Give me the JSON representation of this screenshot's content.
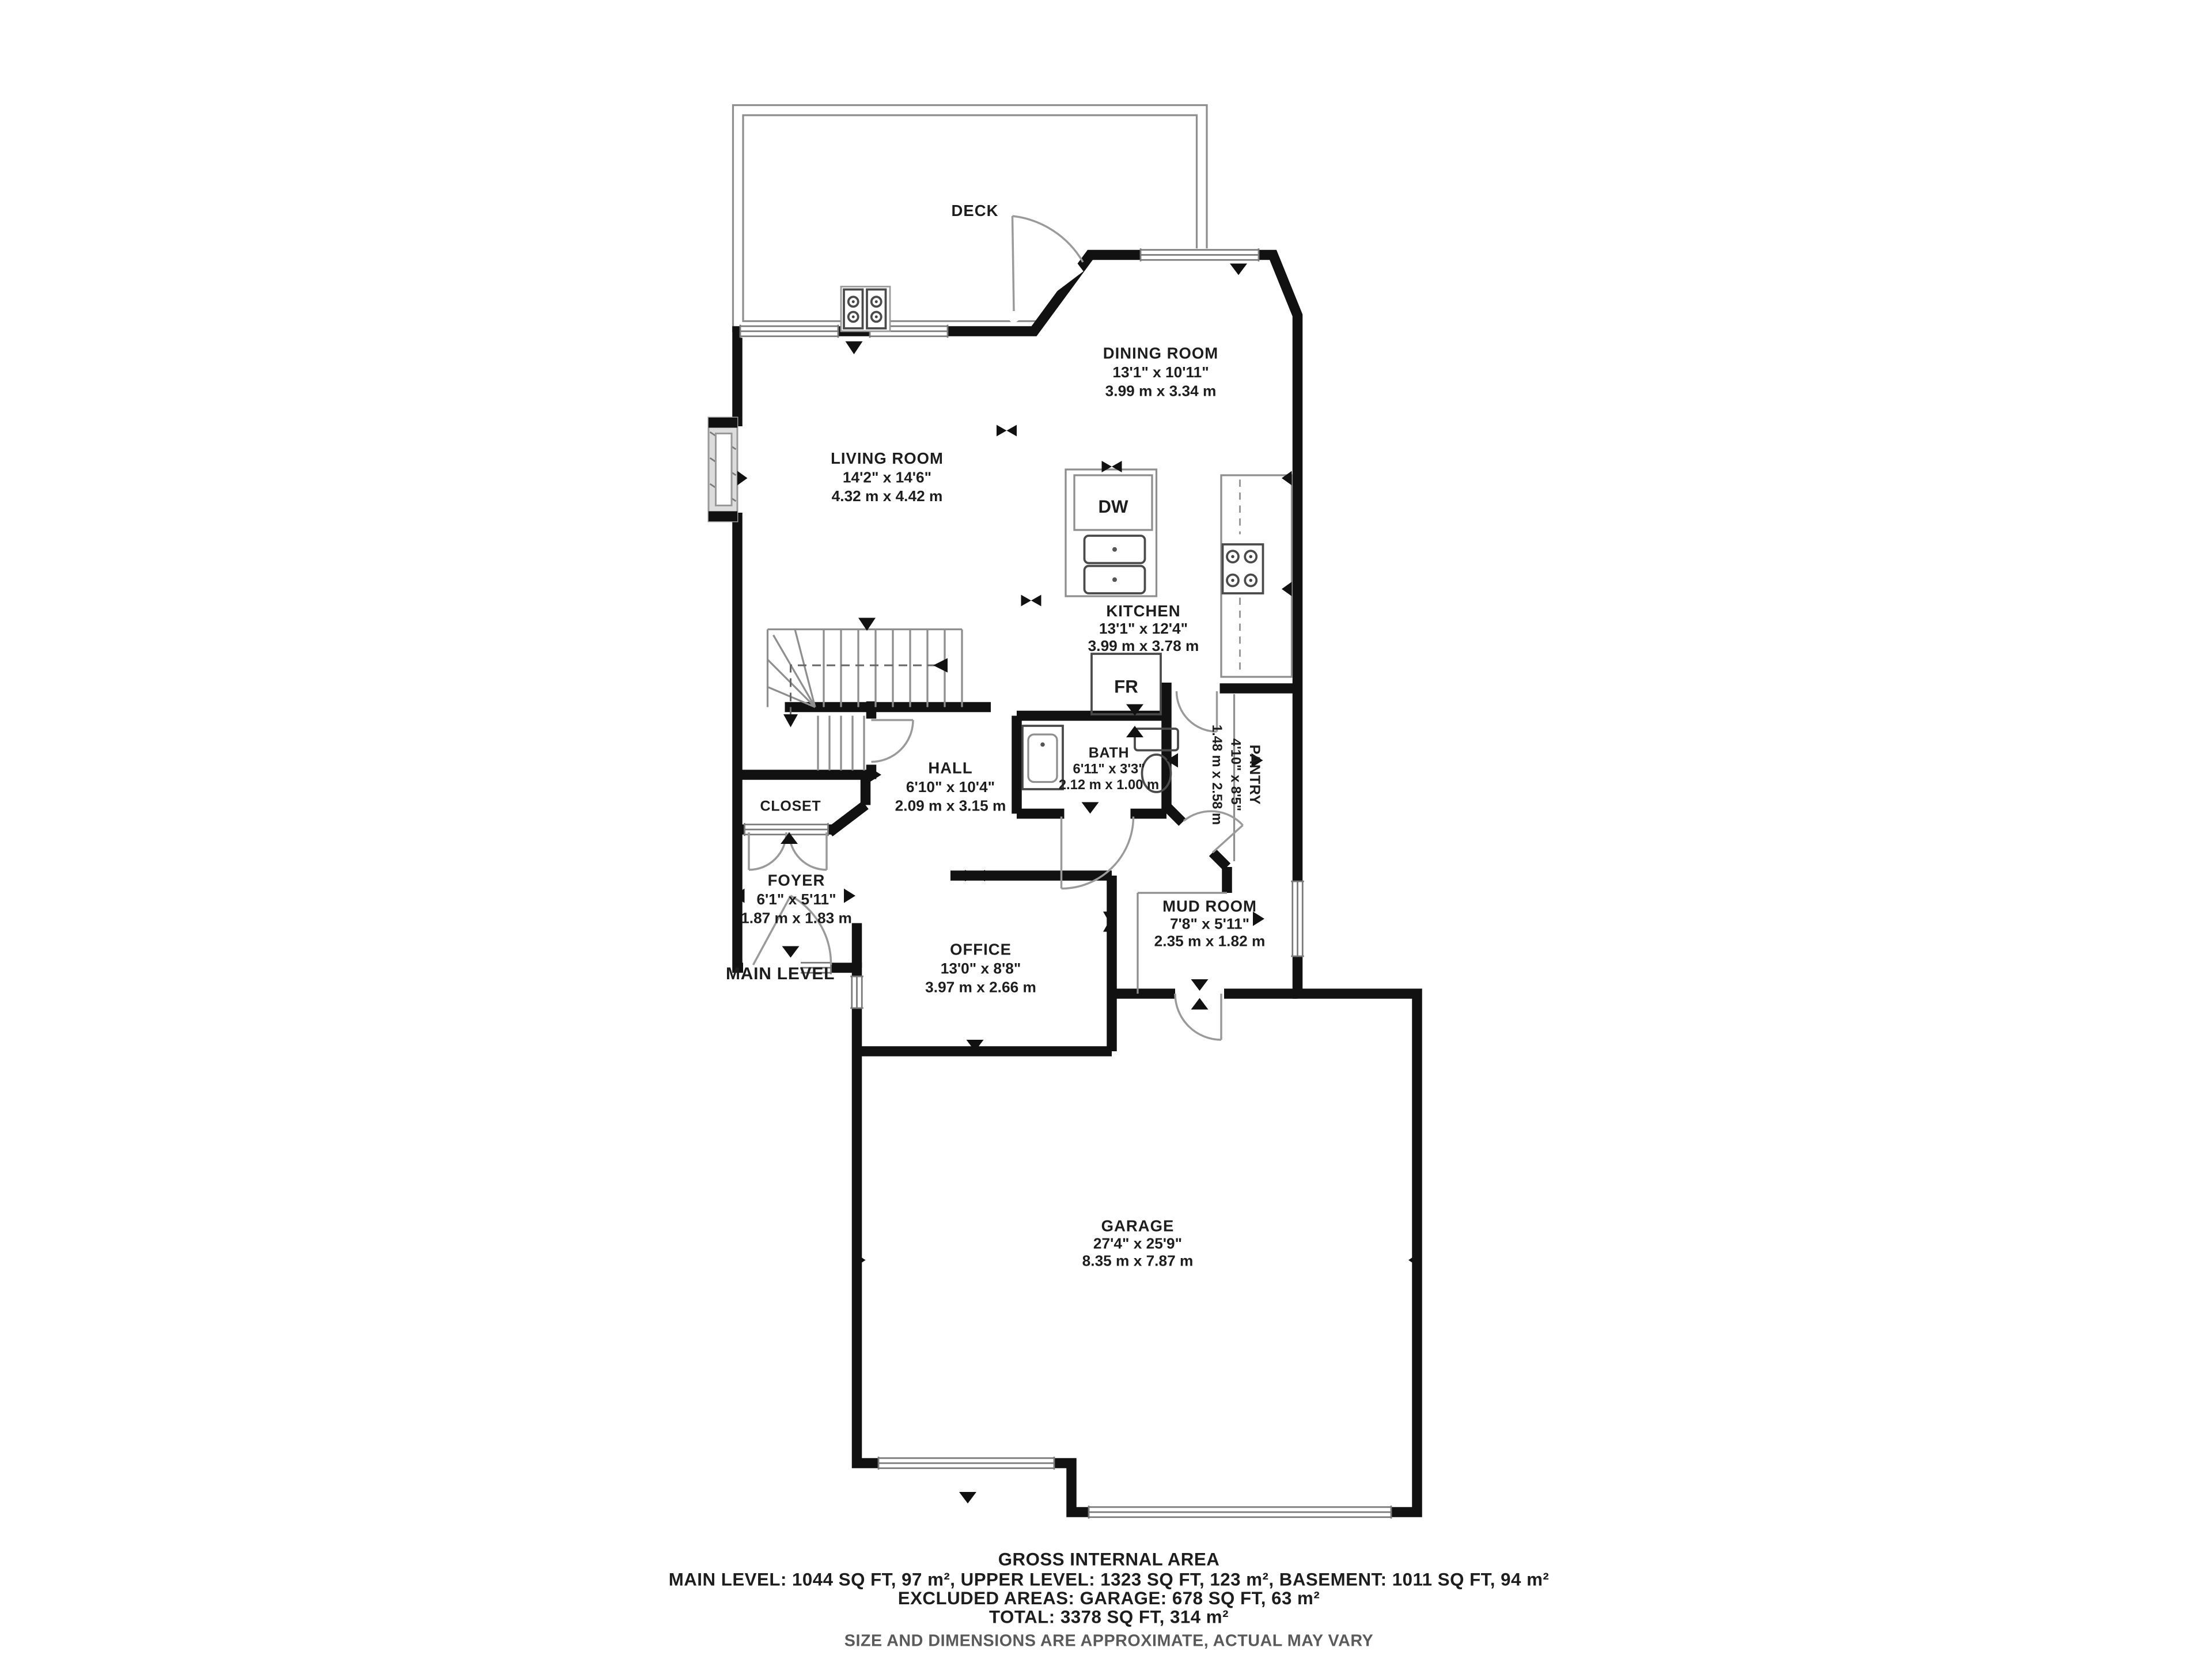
{
  "page": {
    "background": "#ffffff",
    "wall_color": "#111111",
    "fixture_color": "#8e8e8e",
    "text_color": "#1d1d1d",
    "muted_text_color": "#5a5a5a"
  },
  "floor": {
    "label": "MAIN LEVEL"
  },
  "rooms": [
    {
      "name": "DECK",
      "dims_ft": "",
      "dims_m": ""
    },
    {
      "name": "DINING ROOM",
      "dims_ft": "13'1\" x 10'11\"",
      "dims_m": "3.99 m x 3.34 m"
    },
    {
      "name": "LIVING ROOM",
      "dims_ft": "14'2\" x 14'6\"",
      "dims_m": "4.32 m x 4.42 m"
    },
    {
      "name": "KITCHEN",
      "dims_ft": "13'1\" x 12'4\"",
      "dims_m": "3.99 m x 3.78 m"
    },
    {
      "name": "HALL",
      "dims_ft": "6'10\" x 10'4\"",
      "dims_m": "2.09 m x 3.15 m"
    },
    {
      "name": "BATH",
      "dims_ft": "6'11\" x 3'3\"",
      "dims_m": "2.12 m x 1.00 m"
    },
    {
      "name": "PANTRY",
      "dims_ft": "4'10\" x 8'5\"",
      "dims_m": "1.48 m x 2.58 m"
    },
    {
      "name": "CLOSET",
      "dims_ft": "",
      "dims_m": ""
    },
    {
      "name": "FOYER",
      "dims_ft": "6'1\" x 5'11\"",
      "dims_m": "1.87 m x 1.83 m"
    },
    {
      "name": "OFFICE",
      "dims_ft": "13'0\" x 8'8\"",
      "dims_m": "3.97 m x 2.66 m"
    },
    {
      "name": "MUD ROOM",
      "dims_ft": "7'8\" x 5'11\"",
      "dims_m": "2.35 m x 1.82 m"
    },
    {
      "name": "GARAGE",
      "dims_ft": "27'4\" x 25'9\"",
      "dims_m": "8.35 m x 7.87 m"
    }
  ],
  "appliances": {
    "dishwasher": "DW",
    "fridge": "FR"
  },
  "footer": {
    "title": "GROSS INTERNAL AREA",
    "line1": "MAIN LEVEL: 1044 SQ FT, 97 m², UPPER LEVEL: 1323 SQ FT, 123 m², BASEMENT: 1011 SQ FT, 94 m²",
    "line2": "EXCLUDED AREAS: GARAGE: 678 SQ FT, 63 m²",
    "line3": "TOTAL: 3378 SQ FT, 314 m²",
    "disclaimer": "SIZE AND DIMENSIONS ARE APPROXIMATE, ACTUAL MAY VARY"
  }
}
